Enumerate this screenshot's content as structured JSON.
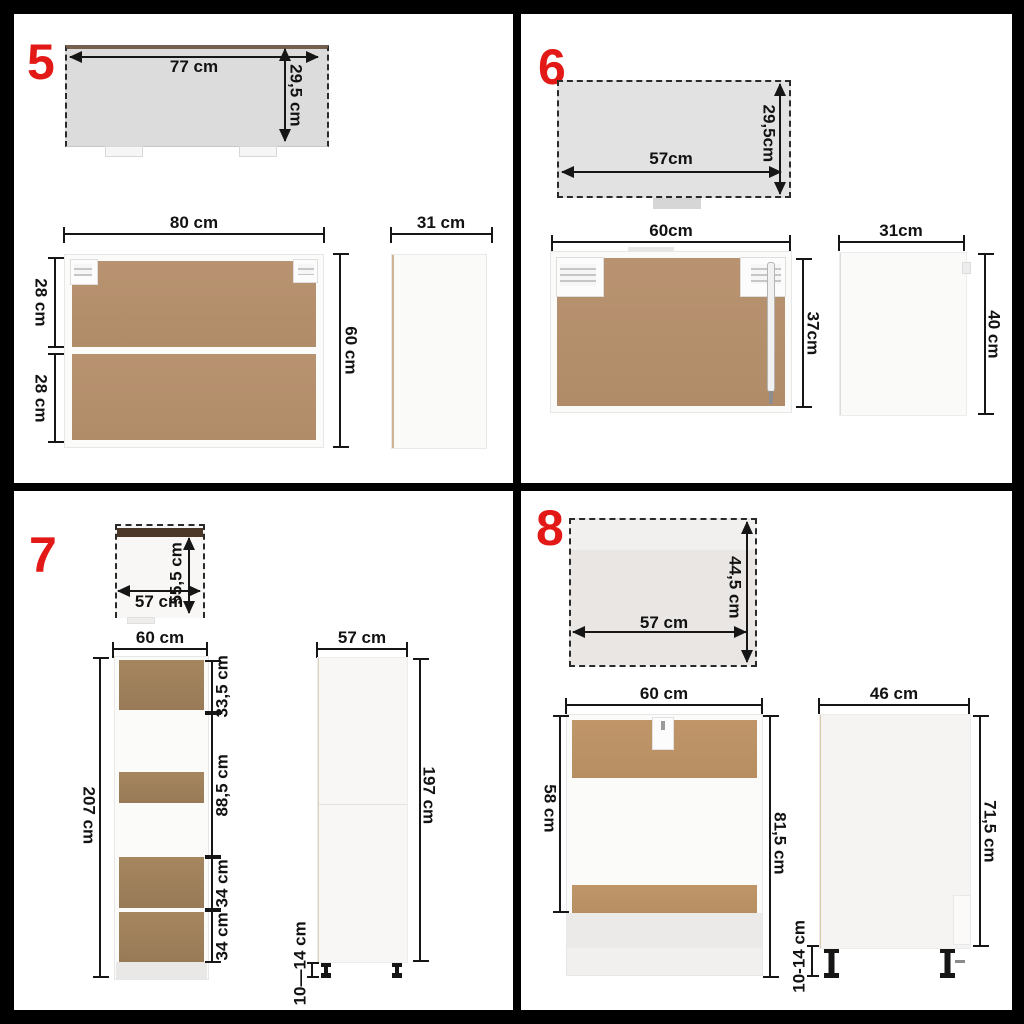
{
  "figure": {
    "background": "#ffffff",
    "frame_color": "#000000",
    "number_color": "#e21916",
    "board_color": "#b5916c",
    "unit": "cm"
  },
  "panels": [
    {
      "number": "5",
      "top_view": {
        "width": "77 cm",
        "depth": "29,5 cm"
      },
      "front_view": {
        "width": "80 cm",
        "height": "60 cm",
        "sections": [
          "28 cm",
          "28 cm"
        ]
      },
      "side_view": {
        "width": "31 cm"
      }
    },
    {
      "number": "6",
      "top_view": {
        "width": "57cm",
        "depth": "29,5cm"
      },
      "front_view": {
        "width": "60cm",
        "height": "37cm"
      },
      "side_view": {
        "width": "31cm",
        "height": "40 cm"
      }
    },
    {
      "number": "7",
      "top_view": {
        "width": "57 cm",
        "depth": "55,5 cm"
      },
      "front_view": {
        "width": "60 cm",
        "height": "207 cm",
        "sections": [
          "33,5 cm",
          "88,5 cm",
          "34 cm",
          "34 cm"
        ]
      },
      "side_view": {
        "width": "57 cm",
        "height": "197 cm",
        "legs_height": "10—14 cm"
      }
    },
    {
      "number": "8",
      "top_view": {
        "width": "57 cm",
        "depth": "44,5 cm"
      },
      "front_view": {
        "width": "60 cm",
        "carcass_height": "58 cm",
        "height": "81,5 cm"
      },
      "side_view": {
        "width": "46 cm",
        "height": "71,5 cm",
        "legs_height": "10-14 cm"
      }
    }
  ]
}
